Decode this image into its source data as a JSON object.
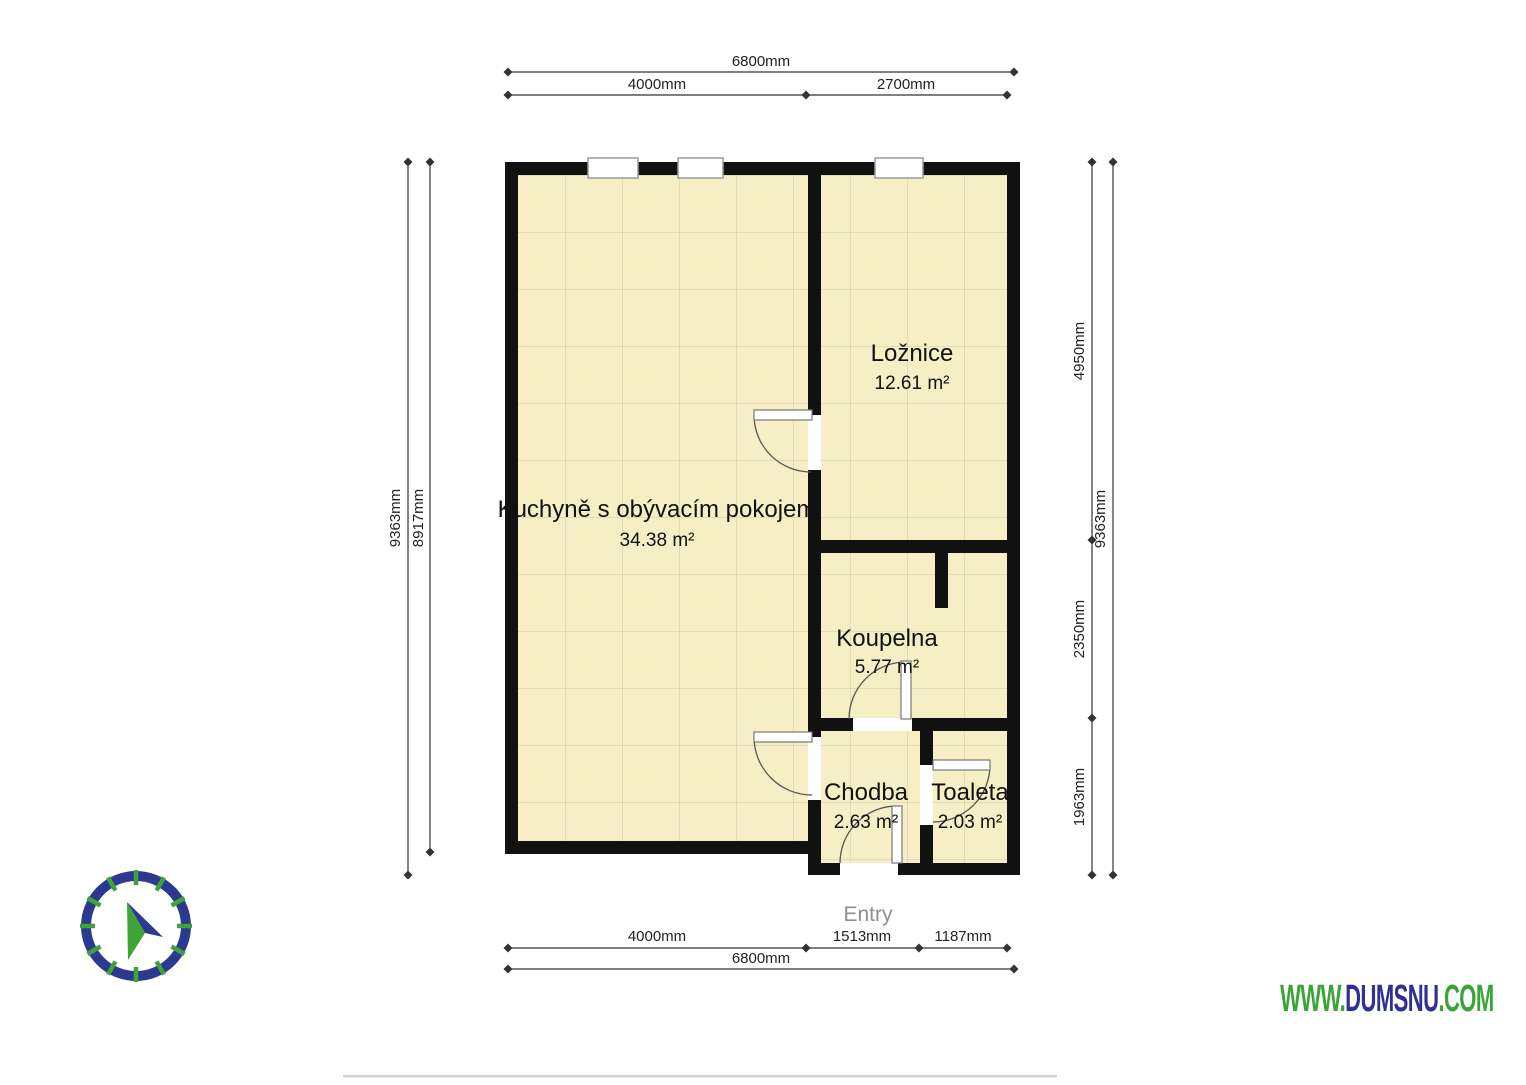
{
  "rooms": [
    {
      "id": "kuchyne",
      "name": "Kuchyně s obývacím pokojem",
      "area": "34.38 m²"
    },
    {
      "id": "loznice",
      "name": "Ložnice",
      "area": "12.61 m²"
    },
    {
      "id": "koupelna",
      "name": "Koupelna",
      "area": "5.77 m²"
    },
    {
      "id": "chodba",
      "name": "Chodba",
      "area": "2.63 m²"
    },
    {
      "id": "toaleta",
      "name": "Toaleta",
      "area": "2.03 m²"
    }
  ],
  "entry_label": "Entry",
  "dimensions": {
    "top_total": "6800mm",
    "top_segments": [
      "4000mm",
      "2700mm"
    ],
    "bottom_segments": [
      "4000mm",
      "1513mm",
      "1187mm"
    ],
    "bottom_total": "6800mm",
    "left_outer": "9363mm",
    "left_inner": "8917mm",
    "right_segments": [
      "4950mm",
      "2350mm",
      "1963mm"
    ],
    "right_outer": "9363mm"
  },
  "branding": {
    "www": "WWW.",
    "domain": "DUMSNU",
    "com": ".COM"
  },
  "colors": {
    "floor": "#f6efc5",
    "floor_grid": "#cfc9a6",
    "wall": "#111111",
    "dimension_line": "#333333",
    "entry_text": "#8f8f8f",
    "brand_green": "#3aa437",
    "brand_navy": "#2e3192",
    "compass_ring_navy": "#2b3a8f",
    "compass_tick_green": "#3fa437"
  }
}
